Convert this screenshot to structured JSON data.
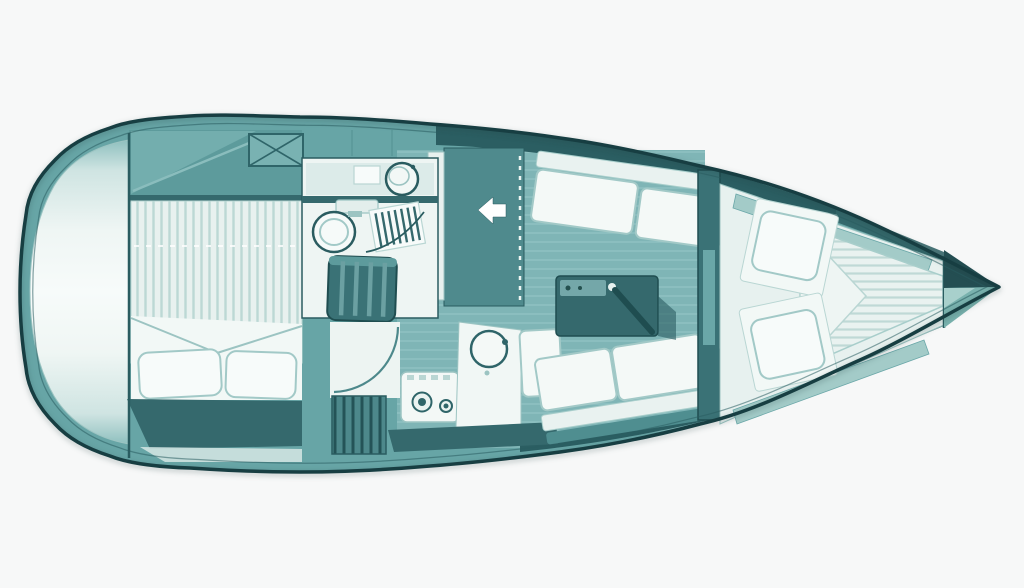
{
  "meta": {
    "title": "sailboat-interior-floor-plan",
    "type": "yacht deck / accommodation plan, bow pointing right",
    "text_content": "none (drawing only)"
  },
  "palette": {
    "background": "#f7f8f8",
    "hull_outline": "#173e42",
    "deck": "#67a5a6",
    "deck_shade": "#5d9b9c",
    "coachroof_dark": "#2b5e62",
    "cabin_floor": "#7fb5b6",
    "panel_white": "#eef5f3",
    "cushion_white": "#f4f9f7",
    "cushion_edge": "#a2c9c7",
    "furniture_dark": "#35696d",
    "steps_fill": "#3a7276",
    "mattress_stripe": "#bcd8d5",
    "stern_light": "#f0f7f5",
    "arrow_white": "#ffffff"
  },
  "legend": [
    "stern-transom-platform",
    "aft-cabin-double-berth",
    "cockpit-locker-hatch",
    "head-compartment-sink",
    "head-compartment-toilet",
    "shower-grate",
    "companionway-steps",
    "companionway-entry-arrow",
    "galley-stove",
    "galley-sink",
    "saloon-port-settee",
    "saloon-starboard-settee",
    "saloon-table",
    "forward-cabin-door",
    "v-berth",
    "bow-anchor-locker"
  ]
}
